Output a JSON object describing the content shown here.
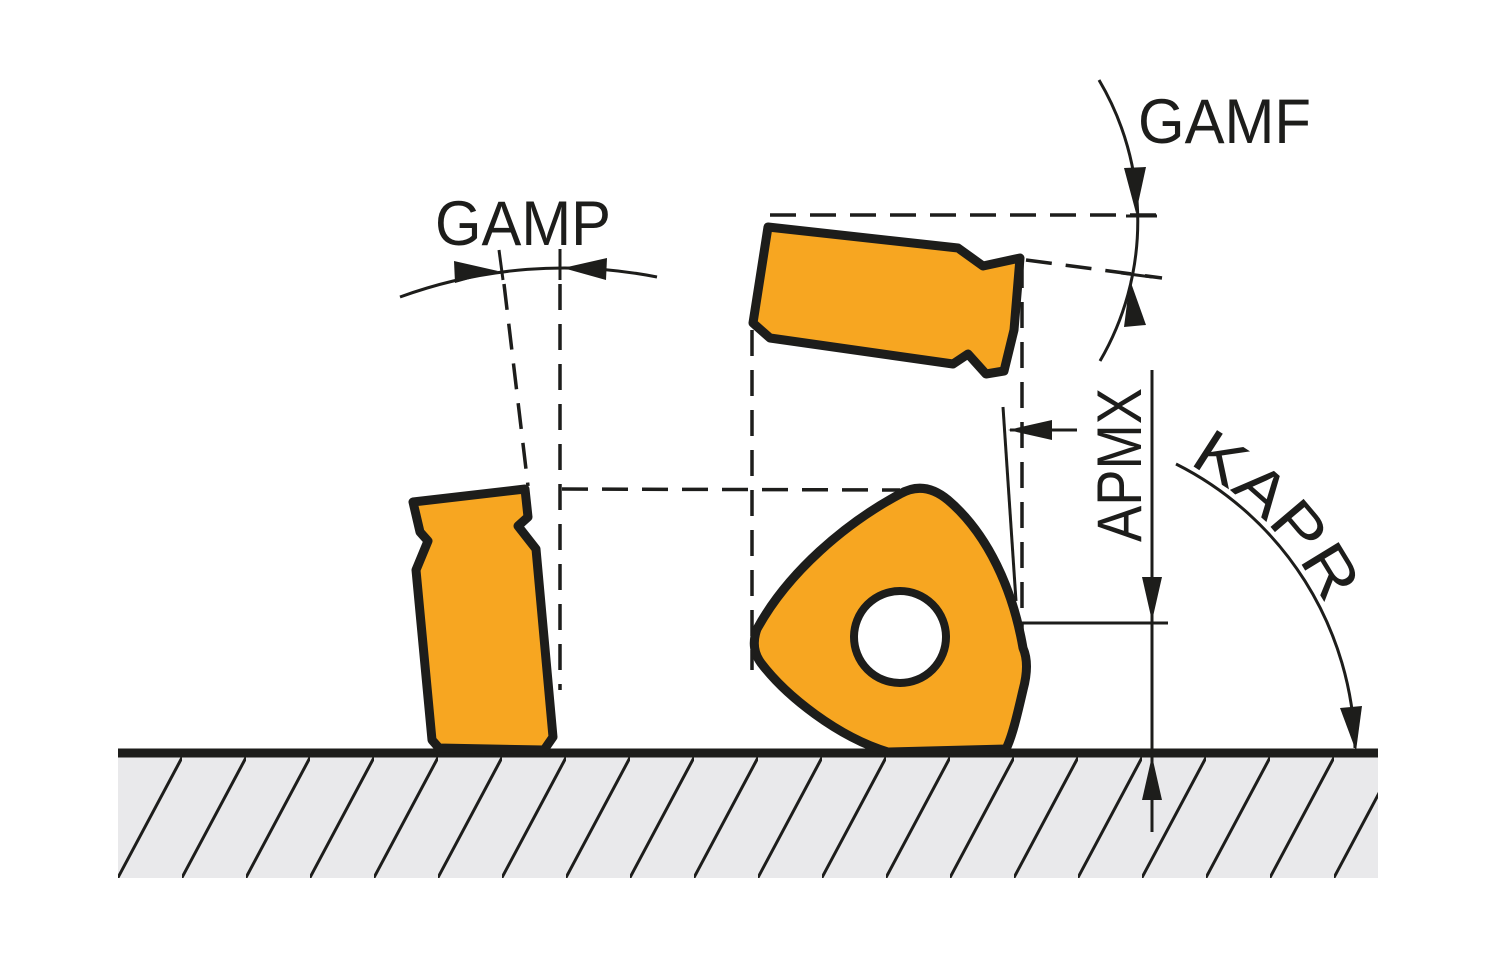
{
  "labels": {
    "gamp": "GAMP",
    "gamf": "GAMF",
    "apmx": "APMX",
    "kapr": "KAPR"
  },
  "colors": {
    "insert_fill": "#F7A621",
    "outline": "#1D1D1B",
    "line": "#1D1D1B",
    "workpiece_fill": "#E9E9EB",
    "background": "#FFFFFF"
  }
}
